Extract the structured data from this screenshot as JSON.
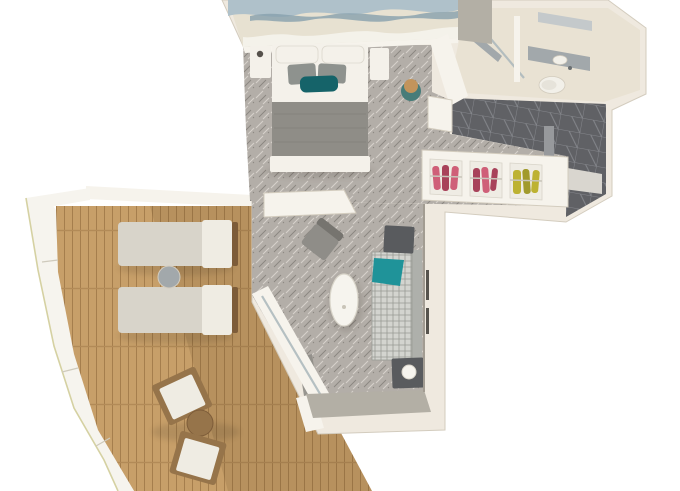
{
  "meta": {
    "type": "3d-floor-plan-render",
    "subject": "Isometric top-down 3D rendering of a cruise-ship suite with private curved balcony",
    "visible_text": "none"
  },
  "colors": {
    "background": "#ffffff",
    "wall": "#efe9df",
    "wall_bright": "#f6f3ec",
    "wall_shadow": "#d3ccbe",
    "wall_gray": "#b3afa5",
    "carpet": "#b3aea8",
    "carpet_light": "#d6d1cb",
    "carpet_dark": "#8b8680",
    "deck": "#c79f69",
    "deck_line": "#a57e4d",
    "deck_joint": "#b28a57",
    "deck_shadow": "#5e431f",
    "tile": "#606165",
    "tile_line": "#85878c",
    "tile_mat": "#97999c",
    "door_panel": "#d9d6cf",
    "bath_floor": "#e9e2d3",
    "fixture": "#a2a8ab",
    "fixture_light": "#c4c9cb",
    "glass": "#a9b6bb",
    "toilet_white": "#f2f0e9",
    "bed_white": "#f4f1ea",
    "pillow_gray": "#8e928e",
    "pillow_teal": "#156369",
    "blanket_gray": "#8f8d87",
    "blanket_fold": "#7d7b75",
    "mural_base": "#e7e1d1",
    "mural_wave": "#afc1ca",
    "mural_wave_dark": "#87a0ad",
    "mural_white": "#f4f2ea",
    "clothes_pink": "#cf5f78",
    "clothes_pink_dark": "#a8425a",
    "clothes_yellow": "#bdb232",
    "clothes_olive": "#a19a2c",
    "sofa_check": "#d3d4cf",
    "sofa_line": "#999b95",
    "sofa_back": "#aeb0ab",
    "throw_teal": "#1f9399",
    "table_dark": "#595b5e",
    "lamp_white": "#f6f4ee",
    "armchair": "#8f8d88",
    "armchair_back": "#76746f",
    "oval_table": "#f6f4ee",
    "lounger": "#d8d4ca",
    "lounger_head": "#efece3",
    "wood_dark": "#7d5c39",
    "wood": "#96744a",
    "rail": "#f6f4ee",
    "rail_edge": "#d5d1a2",
    "stool_top": "#c2945c",
    "stool_base": "#477c79",
    "curtain": "#8f8d88",
    "shadow": "#2a2119"
  },
  "rooms": {
    "bedroom": {
      "name": "Bedroom",
      "items": [
        "wave-art-mural-wall",
        "king-bed",
        "white-pillows",
        "gray-pillows",
        "teal-accent-pillow",
        "gray-runner-blanket",
        "foot-bench",
        "nightstand-left",
        "nightstand-right",
        "vanity-stool",
        "patterned-carpet"
      ]
    },
    "bathroom": {
      "name": "Bathroom",
      "items": [
        "walk-in-shower",
        "glass-partition",
        "vanity-sink",
        "mirror-shelf",
        "toilet"
      ]
    },
    "entry": {
      "name": "Entry hall",
      "items": [
        "dark-tile-floor",
        "doormat",
        "cabin-door-area"
      ]
    },
    "wardrobe": {
      "name": "Open wardrobe",
      "items": [
        "pink-clothes-section",
        "pink-clothes-section-2",
        "yellow-clothes-section",
        "side-panel"
      ]
    },
    "living_room": {
      "name": "Living room",
      "items": [
        "sideboard",
        "armchair",
        "oval-coffee-table",
        "checked-sofa",
        "teal-throw",
        "end-table-top",
        "end-table-bottom",
        "ball-lamp",
        "sliding-glass-door",
        "curtain",
        "threshold"
      ]
    },
    "balcony": {
      "name": "Private balcony",
      "items": [
        "teak-deck",
        "curved-railing",
        "bulkhead-wall",
        "sun-lounger-top",
        "sun-lounger-bottom",
        "round-side-table",
        "bistro-table",
        "bistro-chair-top",
        "bistro-chair-bottom"
      ]
    }
  }
}
